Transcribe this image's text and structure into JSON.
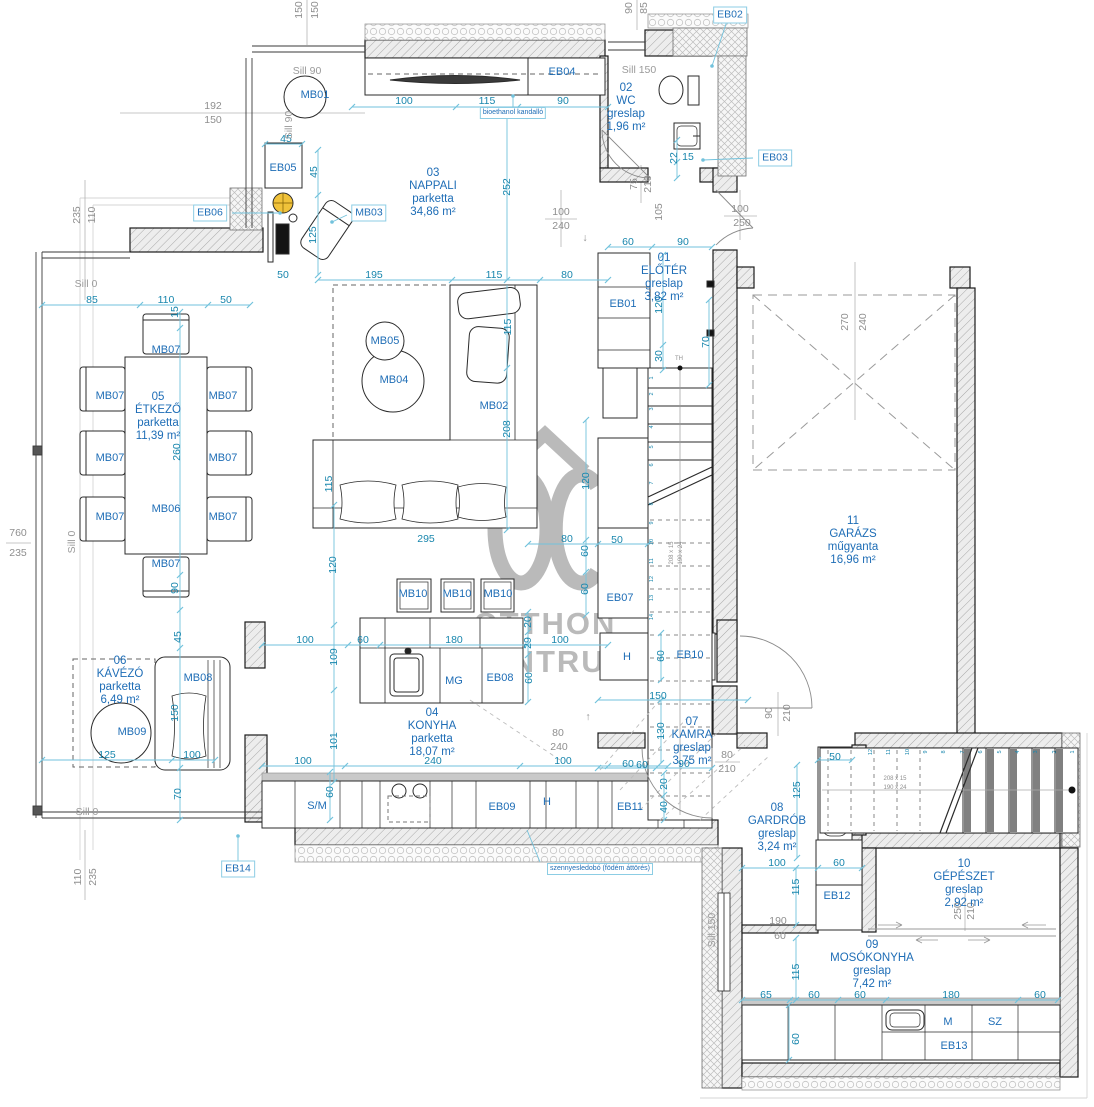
{
  "canvas": {
    "width": 1094,
    "height": 1107,
    "background": "#ffffff"
  },
  "palette": {
    "dim_text": "#1886ad",
    "dim_line": "#72c2dc",
    "label_text": "#1e6db6",
    "box_border": "#8ccde4",
    "gray_text": "#8f8f8f",
    "wall_line": "#1b1b1b",
    "watermark_gray": "#a3a3a3",
    "accent_yellow": "#f0c23a"
  },
  "watermark": {
    "brand_top": "OTTHON",
    "brand_bottom": "CENTRUM"
  },
  "rooms": [
    {
      "id": "01",
      "name": "ELŐTÉR",
      "floor": "greslap",
      "area": "3,82 m²",
      "x": 664,
      "y": 278
    },
    {
      "id": "02",
      "name": "WC",
      "floor": "greslap",
      "area": "1,96 m²",
      "x": 626,
      "y": 108
    },
    {
      "id": "03",
      "name": "NAPPALI",
      "floor": "parketta",
      "area": "34,86 m²",
      "x": 433,
      "y": 193
    },
    {
      "id": "04",
      "name": "KONYHA",
      "floor": "parketta",
      "area": "18,07 m²",
      "x": 432,
      "y": 733
    },
    {
      "id": "05",
      "name": "ÉTKEZŐ",
      "floor": "parketta",
      "area": "11,39 m²",
      "x": 158,
      "y": 417
    },
    {
      "id": "06",
      "name": "KÁVÉZÓ",
      "floor": "parketta",
      "area": "6,49 m²",
      "x": 120,
      "y": 681
    },
    {
      "id": "07",
      "name": "KAMRA",
      "floor": "greslap",
      "area": "3,75 m²",
      "x": 692,
      "y": 742
    },
    {
      "id": "08",
      "name": "GARDRÓB",
      "floor": "greslap",
      "area": "3,24 m²",
      "x": 777,
      "y": 828
    },
    {
      "id": "09",
      "name": "MOSÓKONYHA",
      "floor": "greslap",
      "area": "7,42 m²",
      "x": 872,
      "y": 965
    },
    {
      "id": "10",
      "name": "GÉPÉSZET",
      "floor": "greslap",
      "area": "2,92 m²",
      "x": 964,
      "y": 884
    },
    {
      "id": "11",
      "name": "GARÁZS",
      "floor": "műgyanta",
      "area": "16,96 m²",
      "x": 853,
      "y": 541
    }
  ],
  "texts": [
    {
      "t": "100",
      "x": 404,
      "y": 101,
      "c": "dim"
    },
    {
      "t": "115",
      "x": 487,
      "y": 101,
      "c": "dim"
    },
    {
      "t": "90",
      "x": 563,
      "y": 101,
      "c": "dim"
    },
    {
      "t": "45",
      "x": 286,
      "y": 139,
      "c": "dim"
    },
    {
      "t": "45",
      "x": 314,
      "y": 172,
      "c": "dim",
      "v": 1
    },
    {
      "t": "125",
      "x": 313,
      "y": 235,
      "c": "dim",
      "v": 1
    },
    {
      "t": "252",
      "x": 507,
      "y": 187,
      "c": "dim",
      "v": 1
    },
    {
      "t": "50",
      "x": 283,
      "y": 275,
      "c": "dim"
    },
    {
      "t": "195",
      "x": 374,
      "y": 275,
      "c": "dim"
    },
    {
      "t": "115",
      "x": 494,
      "y": 275,
      "c": "dim"
    },
    {
      "t": "80",
      "x": 567,
      "y": 275,
      "c": "dim"
    },
    {
      "t": "60",
      "x": 628,
      "y": 242,
      "c": "dim"
    },
    {
      "t": "90",
      "x": 683,
      "y": 242,
      "c": "dim"
    },
    {
      "t": "85",
      "x": 92,
      "y": 300,
      "c": "dim"
    },
    {
      "t": "110",
      "x": 166,
      "y": 300,
      "c": "dim"
    },
    {
      "t": "50",
      "x": 226,
      "y": 300,
      "c": "dim"
    },
    {
      "t": "15",
      "x": 175,
      "y": 312,
      "c": "dim",
      "v": 1
    },
    {
      "t": "260",
      "x": 177,
      "y": 452,
      "c": "dim",
      "v": 1
    },
    {
      "t": "90",
      "x": 175,
      "y": 588,
      "c": "dim",
      "v": 1
    },
    {
      "t": "45",
      "x": 178,
      "y": 637,
      "c": "dim",
      "v": 1
    },
    {
      "t": "150",
      "x": 175,
      "y": 713,
      "c": "dim",
      "v": 1
    },
    {
      "t": "70",
      "x": 178,
      "y": 794,
      "c": "dim",
      "v": 1
    },
    {
      "t": "115",
      "x": 508,
      "y": 327,
      "c": "dim",
      "v": 1
    },
    {
      "t": "208",
      "x": 507,
      "y": 429,
      "c": "dim",
      "v": 1
    },
    {
      "t": "115",
      "x": 329,
      "y": 484,
      "c": "dim",
      "v": 1
    },
    {
      "t": "295",
      "x": 426,
      "y": 539,
      "c": "dim"
    },
    {
      "t": "80",
      "x": 567,
      "y": 539,
      "c": "dim"
    },
    {
      "t": "50",
      "x": 617,
      "y": 540,
      "c": "dim"
    },
    {
      "t": "120",
      "x": 586,
      "y": 481,
      "c": "dim",
      "v": 1
    },
    {
      "t": "60",
      "x": 585,
      "y": 551,
      "c": "dim",
      "v": 1
    },
    {
      "t": "60",
      "x": 585,
      "y": 589,
      "c": "dim",
      "v": 1
    },
    {
      "t": "120",
      "x": 659,
      "y": 305,
      "c": "dim",
      "v": 1
    },
    {
      "t": "30",
      "x": 659,
      "y": 356,
      "c": "dim",
      "v": 1
    },
    {
      "t": "70",
      "x": 706,
      "y": 342,
      "c": "dim",
      "v": 1
    },
    {
      "t": "22",
      "x": 674,
      "y": 158,
      "c": "dim",
      "v": 1
    },
    {
      "t": "15",
      "x": 688,
      "y": 157,
      "c": "dim"
    },
    {
      "t": "120",
      "x": 333,
      "y": 565,
      "c": "dim",
      "v": 1
    },
    {
      "t": "109",
      "x": 334,
      "y": 657,
      "c": "dim",
      "v": 1
    },
    {
      "t": "101",
      "x": 334,
      "y": 741,
      "c": "dim",
      "v": 1
    },
    {
      "t": "100",
      "x": 305,
      "y": 640,
      "c": "dim"
    },
    {
      "t": "60",
      "x": 363,
      "y": 640,
      "c": "dim"
    },
    {
      "t": "180",
      "x": 454,
      "y": 640,
      "c": "dim"
    },
    {
      "t": "100",
      "x": 560,
      "y": 640,
      "c": "dim"
    },
    {
      "t": "20",
      "x": 528,
      "y": 622,
      "c": "dim",
      "v": 1
    },
    {
      "t": "29",
      "x": 528,
      "y": 643,
      "c": "dim",
      "v": 1
    },
    {
      "t": "60",
      "x": 529,
      "y": 678,
      "c": "dim",
      "v": 1
    },
    {
      "t": "100",
      "x": 303,
      "y": 761,
      "c": "dim"
    },
    {
      "t": "240",
      "x": 433,
      "y": 761,
      "c": "dim"
    },
    {
      "t": "100",
      "x": 563,
      "y": 761,
      "c": "dim"
    },
    {
      "t": "60",
      "x": 642,
      "y": 765,
      "c": "dim"
    },
    {
      "t": "60",
      "x": 330,
      "y": 792,
      "c": "dim",
      "v": 1
    },
    {
      "t": "20",
      "x": 664,
      "y": 784,
      "c": "dim",
      "v": 1
    },
    {
      "t": "40",
      "x": 664,
      "y": 807,
      "c": "dim",
      "v": 1
    },
    {
      "t": "60",
      "x": 661,
      "y": 656,
      "c": "dim",
      "v": 1
    },
    {
      "t": "150",
      "x": 658,
      "y": 696,
      "c": "dim"
    },
    {
      "t": "130",
      "x": 661,
      "y": 731,
      "c": "dim",
      "v": 1
    },
    {
      "t": "60",
      "x": 628,
      "y": 764,
      "c": "dim"
    },
    {
      "t": "90",
      "x": 684,
      "y": 764,
      "c": "dim"
    },
    {
      "t": "125",
      "x": 797,
      "y": 790,
      "c": "dim",
      "v": 1
    },
    {
      "t": "50",
      "x": 835,
      "y": 757,
      "c": "dim"
    },
    {
      "t": "100",
      "x": 777,
      "y": 863,
      "c": "dim"
    },
    {
      "t": "60",
      "x": 839,
      "y": 863,
      "c": "dim"
    },
    {
      "t": "115",
      "x": 796,
      "y": 887,
      "c": "dim",
      "v": 1
    },
    {
      "t": "115",
      "x": 796,
      "y": 972,
      "c": "dim",
      "v": 1
    },
    {
      "t": "65",
      "x": 766,
      "y": 995,
      "c": "dim"
    },
    {
      "t": "60",
      "x": 814,
      "y": 995,
      "c": "dim"
    },
    {
      "t": "60",
      "x": 860,
      "y": 995,
      "c": "dim"
    },
    {
      "t": "180",
      "x": 951,
      "y": 995,
      "c": "dim"
    },
    {
      "t": "60",
      "x": 1040,
      "y": 995,
      "c": "dim"
    },
    {
      "t": "60",
      "x": 796,
      "y": 1039,
      "c": "dim",
      "v": 1
    },
    {
      "t": "125",
      "x": 107,
      "y": 755,
      "c": "dim"
    },
    {
      "t": "100",
      "x": 192,
      "y": 755,
      "c": "dim"
    },
    {
      "t": "192",
      "x": 213,
      "y": 106,
      "c": "gray"
    },
    {
      "t": "150",
      "x": 213,
      "y": 120,
      "c": "gray"
    },
    {
      "t": "100",
      "x": 561,
      "y": 212,
      "c": "gray"
    },
    {
      "t": "240",
      "x": 561,
      "y": 226,
      "c": "gray"
    },
    {
      "t": "100",
      "x": 740,
      "y": 209,
      "c": "gray"
    },
    {
      "t": "250",
      "x": 742,
      "y": 223,
      "c": "gray"
    },
    {
      "t": "75",
      "x": 634,
      "y": 184,
      "c": "gray",
      "v": 1
    },
    {
      "t": "210",
      "x": 648,
      "y": 184,
      "c": "gray",
      "v": 1
    },
    {
      "t": "105",
      "x": 659,
      "y": 212,
      "c": "gray",
      "v": 1
    },
    {
      "t": "270",
      "x": 845,
      "y": 322,
      "c": "gray",
      "v": 1
    },
    {
      "t": "240",
      "x": 863,
      "y": 322,
      "c": "gray",
      "v": 1
    },
    {
      "t": "235",
      "x": 77,
      "y": 215,
      "c": "gray",
      "v": 1
    },
    {
      "t": "110",
      "x": 92,
      "y": 215,
      "c": "gray",
      "v": 1
    },
    {
      "t": "760",
      "x": 18,
      "y": 533,
      "c": "gray"
    },
    {
      "t": "235",
      "x": 18,
      "y": 553,
      "c": "gray"
    },
    {
      "t": "110",
      "x": 78,
      "y": 877,
      "c": "gray",
      "v": 1
    },
    {
      "t": "235",
      "x": 93,
      "y": 877,
      "c": "gray",
      "v": 1
    },
    {
      "t": "150",
      "x": 299,
      "y": 10,
      "c": "gray",
      "v": 1
    },
    {
      "t": "150",
      "x": 315,
      "y": 10,
      "c": "gray",
      "v": 1
    },
    {
      "t": "90",
      "x": 629,
      "y": 8,
      "c": "gray",
      "v": 1
    },
    {
      "t": "85",
      "x": 644,
      "y": 8,
      "c": "gray",
      "v": 1
    },
    {
      "t": "80",
      "x": 558,
      "y": 733,
      "c": "gray"
    },
    {
      "t": "240",
      "x": 559,
      "y": 747,
      "c": "gray"
    },
    {
      "t": "80",
      "x": 727,
      "y": 755,
      "c": "gray"
    },
    {
      "t": "210",
      "x": 727,
      "y": 769,
      "c": "gray"
    },
    {
      "t": "90",
      "x": 769,
      "y": 713,
      "c": "gray",
      "v": 1
    },
    {
      "t": "210",
      "x": 787,
      "y": 713,
      "c": "gray",
      "v": 1
    },
    {
      "t": "190",
      "x": 778,
      "y": 921,
      "c": "gray"
    },
    {
      "t": "60",
      "x": 780,
      "y": 936,
      "c": "gray"
    },
    {
      "t": "250",
      "x": 958,
      "y": 911,
      "c": "gray",
      "v": 1
    },
    {
      "t": "210",
      "x": 971,
      "y": 911,
      "c": "gray",
      "v": 1
    },
    {
      "t": "TH",
      "x": 679,
      "y": 359,
      "c": "tiny"
    },
    {
      "t": "↓",
      "x": 585,
      "y": 238,
      "c": "gray"
    },
    {
      "t": "↑",
      "x": 588,
      "y": 717,
      "c": "gray"
    },
    {
      "t": "Sill 90",
      "x": 307,
      "y": 71,
      "c": "sill"
    },
    {
      "t": "Sill 90",
      "x": 289,
      "y": 125,
      "c": "sill",
      "v": 1
    },
    {
      "t": "Sill 150",
      "x": 639,
      "y": 70,
      "c": "sill"
    },
    {
      "t": "Sill 0",
      "x": 86,
      "y": 284,
      "c": "sill"
    },
    {
      "t": "Sill 0",
      "x": 72,
      "y": 542,
      "c": "sill",
      "v": 1
    },
    {
      "t": "Sill 0",
      "x": 87,
      "y": 812,
      "c": "sill"
    },
    {
      "t": "Sill 150",
      "x": 712,
      "y": 930,
      "c": "sill",
      "v": 1
    },
    {
      "t": "EB01",
      "x": 623,
      "y": 304,
      "c": "tag"
    },
    {
      "t": "EB04",
      "x": 562,
      "y": 72,
      "c": "tag"
    },
    {
      "t": "EB05",
      "x": 283,
      "y": 168,
      "c": "tag"
    },
    {
      "t": "EB07",
      "x": 620,
      "y": 598,
      "c": "tag"
    },
    {
      "t": "EB08",
      "x": 500,
      "y": 678,
      "c": "tag"
    },
    {
      "t": "EB09",
      "x": 502,
      "y": 807,
      "c": "tag"
    },
    {
      "t": "EB10",
      "x": 690,
      "y": 655,
      "c": "tag"
    },
    {
      "t": "EB11",
      "x": 630,
      "y": 807,
      "c": "tag"
    },
    {
      "t": "EB12",
      "x": 837,
      "y": 896,
      "c": "tag"
    },
    {
      "t": "EB13",
      "x": 954,
      "y": 1046,
      "c": "tag"
    },
    {
      "t": "H",
      "x": 627,
      "y": 657,
      "c": "tag"
    },
    {
      "t": "H",
      "x": 547,
      "y": 802,
      "c": "tag"
    },
    {
      "t": "MG",
      "x": 454,
      "y": 681,
      "c": "tag"
    },
    {
      "t": "S/M",
      "x": 317,
      "y": 806,
      "c": "tag"
    },
    {
      "t": "M",
      "x": 948,
      "y": 1022,
      "c": "tag"
    },
    {
      "t": "SZ",
      "x": 995,
      "y": 1022,
      "c": "tag"
    },
    {
      "t": "MB01",
      "x": 315,
      "y": 95,
      "c": "tag"
    },
    {
      "t": "MB02",
      "x": 494,
      "y": 406,
      "c": "tag"
    },
    {
      "t": "MB04",
      "x": 394,
      "y": 380,
      "c": "tag"
    },
    {
      "t": "MB05",
      "x": 385,
      "y": 341,
      "c": "tag"
    },
    {
      "t": "MB06",
      "x": 166,
      "y": 509,
      "c": "tag"
    },
    {
      "t": "MB07",
      "x": 166,
      "y": 350,
      "c": "tag"
    },
    {
      "t": "MB07",
      "x": 110,
      "y": 396,
      "c": "tag"
    },
    {
      "t": "MB07",
      "x": 110,
      "y": 458,
      "c": "tag"
    },
    {
      "t": "MB07",
      "x": 110,
      "y": 517,
      "c": "tag"
    },
    {
      "t": "MB07",
      "x": 223,
      "y": 396,
      "c": "tag"
    },
    {
      "t": "MB07",
      "x": 223,
      "y": 458,
      "c": "tag"
    },
    {
      "t": "MB07",
      "x": 223,
      "y": 517,
      "c": "tag"
    },
    {
      "t": "MB07",
      "x": 166,
      "y": 564,
      "c": "tag"
    },
    {
      "t": "MB08",
      "x": 198,
      "y": 678,
      "c": "tag"
    },
    {
      "t": "MB09",
      "x": 132,
      "y": 732,
      "c": "tag"
    },
    {
      "t": "MB10",
      "x": 413,
      "y": 594,
      "c": "tag"
    },
    {
      "t": "MB10",
      "x": 457,
      "y": 594,
      "c": "tag"
    },
    {
      "t": "MB10",
      "x": 498,
      "y": 594,
      "c": "tag"
    },
    {
      "t": "EB02",
      "x": 730,
      "y": 15,
      "c": "box"
    },
    {
      "t": "EB03",
      "x": 775,
      "y": 158,
      "c": "box"
    },
    {
      "t": "EB06",
      "x": 210,
      "y": 213,
      "c": "box"
    },
    {
      "t": "MB03",
      "x": 369,
      "y": 213,
      "c": "box"
    },
    {
      "t": "EB14",
      "x": 238,
      "y": 869,
      "c": "box"
    },
    {
      "t": "bioethanol kandalló",
      "x": 513,
      "y": 113,
      "c": "boxsm"
    },
    {
      "t": "szennyesledobó (födém áttörés)",
      "x": 600,
      "y": 869,
      "c": "boxsm"
    },
    {
      "t": "1",
      "x": 652,
      "y": 378,
      "c": "num",
      "v": 1
    },
    {
      "t": "2",
      "x": 652,
      "y": 394,
      "c": "num",
      "v": 1
    },
    {
      "t": "3",
      "x": 652,
      "y": 409,
      "c": "num",
      "v": 1
    },
    {
      "t": "4",
      "x": 652,
      "y": 427,
      "c": "num",
      "v": 1
    },
    {
      "t": "5",
      "x": 652,
      "y": 447,
      "c": "num",
      "v": 1
    },
    {
      "t": "6",
      "x": 652,
      "y": 465,
      "c": "num",
      "v": 1
    },
    {
      "t": "7",
      "x": 652,
      "y": 483,
      "c": "num",
      "v": 1
    },
    {
      "t": "8",
      "x": 652,
      "y": 504,
      "c": "num",
      "v": 1
    },
    {
      "t": "9",
      "x": 652,
      "y": 523,
      "c": "num",
      "v": 1
    },
    {
      "t": "10",
      "x": 652,
      "y": 542,
      "c": "num",
      "v": 1
    },
    {
      "t": "11",
      "x": 652,
      "y": 561,
      "c": "num",
      "v": 1
    },
    {
      "t": "12",
      "x": 652,
      "y": 579,
      "c": "num",
      "v": 1
    },
    {
      "t": "13",
      "x": 652,
      "y": 598,
      "c": "num",
      "v": 1
    },
    {
      "t": "14",
      "x": 652,
      "y": 617,
      "c": "num",
      "v": 1
    },
    {
      "t": "1",
      "x": 1073,
      "y": 752,
      "c": "num",
      "v": 1
    },
    {
      "t": "2",
      "x": 1055,
      "y": 752,
      "c": "num",
      "v": 1
    },
    {
      "t": "3",
      "x": 1036,
      "y": 752,
      "c": "num",
      "v": 1
    },
    {
      "t": "4",
      "x": 1018,
      "y": 752,
      "c": "num",
      "v": 1
    },
    {
      "t": "5",
      "x": 1000,
      "y": 752,
      "c": "num",
      "v": 1
    },
    {
      "t": "6",
      "x": 981,
      "y": 752,
      "c": "num",
      "v": 1
    },
    {
      "t": "7",
      "x": 963,
      "y": 752,
      "c": "num",
      "v": 1
    },
    {
      "t": "8",
      "x": 944,
      "y": 752,
      "c": "num",
      "v": 1
    },
    {
      "t": "9",
      "x": 926,
      "y": 752,
      "c": "num",
      "v": 1
    },
    {
      "t": "10",
      "x": 908,
      "y": 752,
      "c": "num",
      "v": 1
    },
    {
      "t": "11",
      "x": 889,
      "y": 752,
      "c": "num",
      "v": 1
    },
    {
      "t": "12",
      "x": 871,
      "y": 752,
      "c": "num",
      "v": 1
    },
    {
      "t": "208 x 15",
      "x": 672,
      "y": 553,
      "c": "tiny",
      "v": 1
    },
    {
      "t": "190 x 24",
      "x": 681,
      "y": 553,
      "c": "tiny",
      "v": 1
    },
    {
      "t": "208 x 15",
      "x": 895,
      "y": 779,
      "c": "tiny"
    },
    {
      "t": "190 x 24",
      "x": 895,
      "y": 788,
      "c": "tiny"
    }
  ]
}
